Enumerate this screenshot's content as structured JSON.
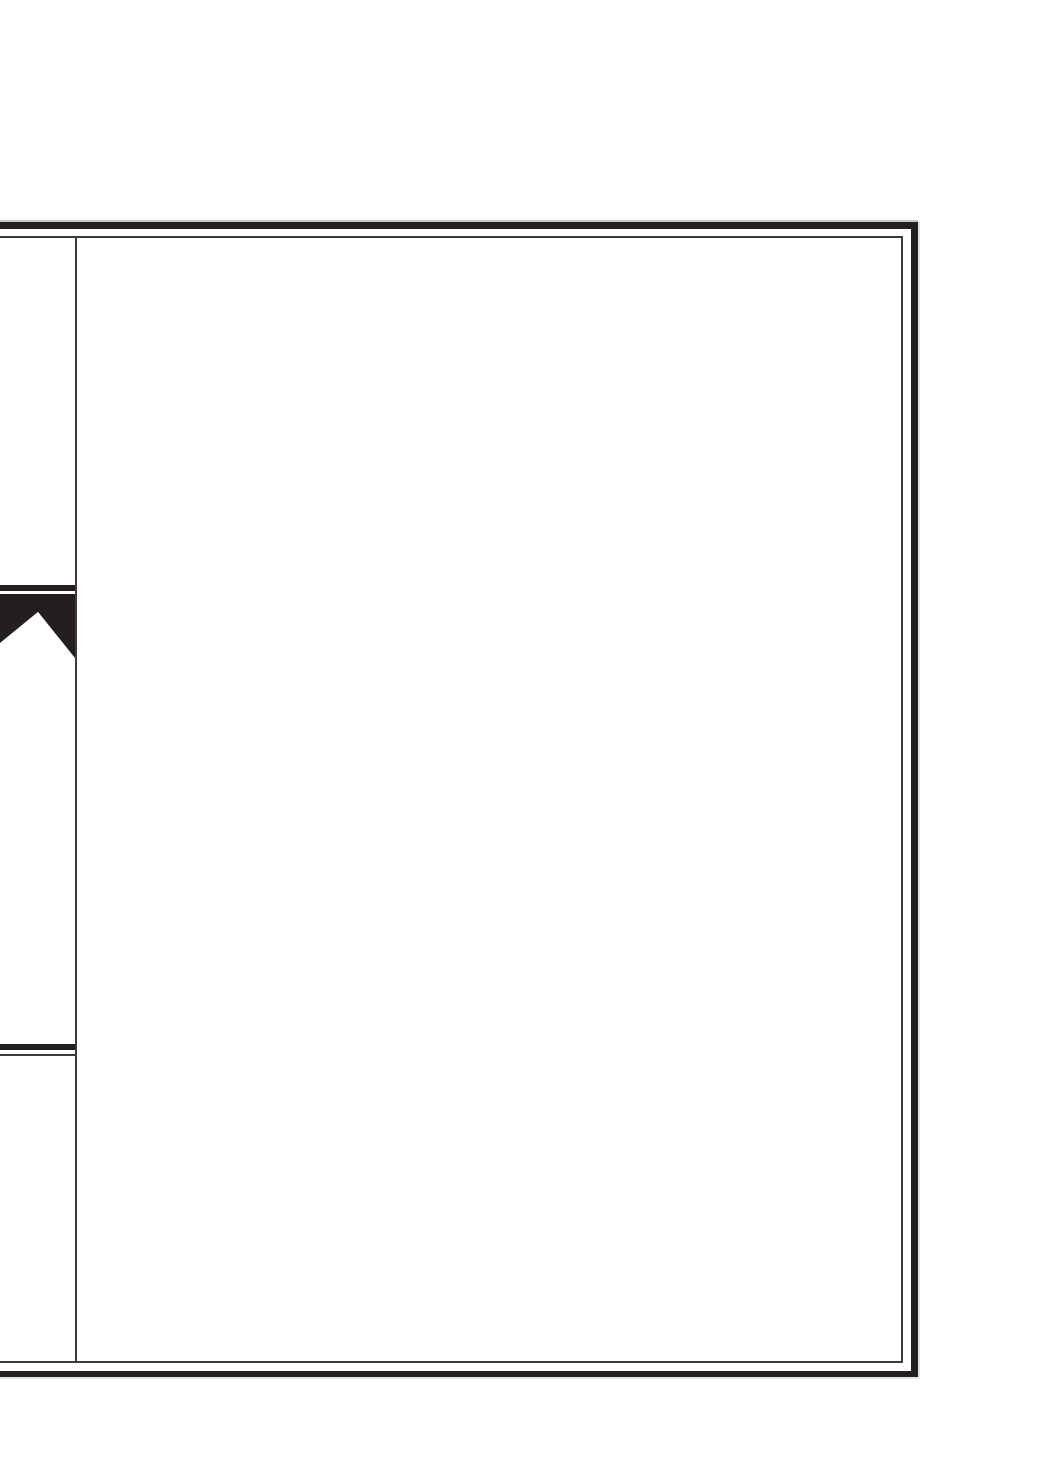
{
  "page": {
    "kind": "blank-scanned-page",
    "text_content": ""
  },
  "colors": {
    "paper": "#ffffff",
    "ink": "#231f20",
    "line": "#3e393b"
  }
}
